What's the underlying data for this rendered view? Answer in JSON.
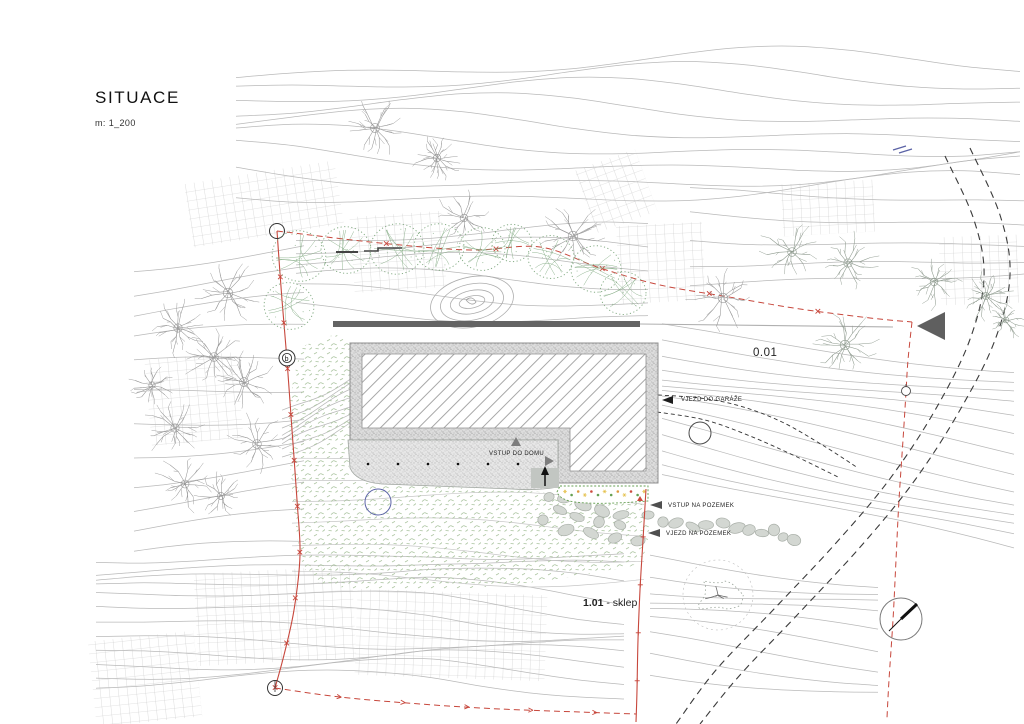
{
  "title": {
    "text": "SITUACE",
    "scale": "m: 1_200"
  },
  "labels": {
    "garage": "VJEZD DO GARÁŽE",
    "house_entry": "VSTUP DO DOMU",
    "site_entry_foot": "VSTUP NA POZEMEK",
    "site_entry_vehicle": "VJEZD NA POZEMEK",
    "area_main": "0.01",
    "area_cellar_num": "1.01",
    "area_cellar_suffix": " - sklep",
    "boundary_marker": "b"
  },
  "colors": {
    "boundary_red": "#c7473c",
    "contour": "#b9b9b9",
    "contour_faint": "#c6c6c6",
    "tree_gray": "#969696",
    "tree_gray_green": "#8e9a8e",
    "tree_green": "#7fa87f",
    "lawn_green": "#aec6a3",
    "wall_dark": "#646464",
    "hatch_gray": "#9d9d9d",
    "stone": "#d3d7d2",
    "stone_edge": "#a9afa8",
    "road_dark": "#3a3a3a",
    "blue": "#5b63a6",
    "flower_yellow": "#e4c04a",
    "flower_orange": "#dd9a3f",
    "flower_green": "#66a053",
    "flower_red": "#cc4b40",
    "triangle_dark": "#5f5f5f"
  }
}
